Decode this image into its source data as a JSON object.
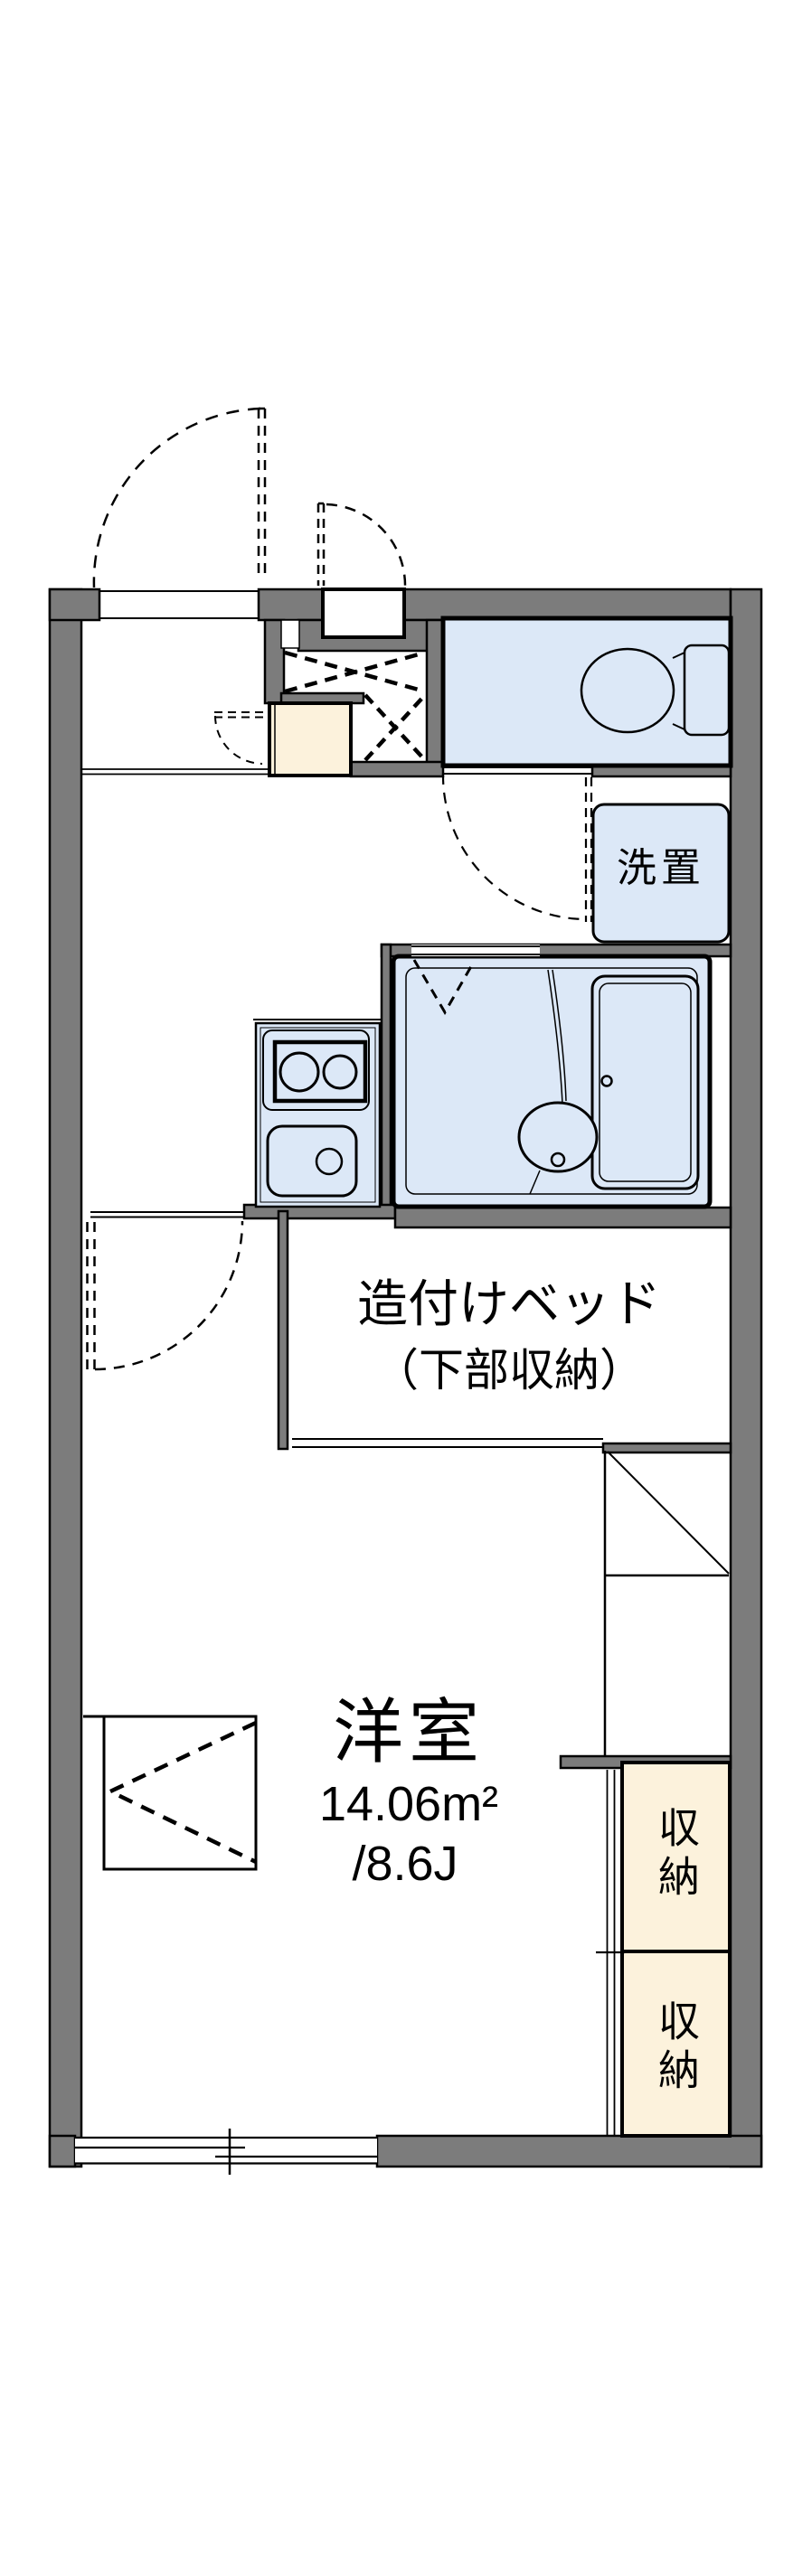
{
  "colors": {
    "wall": "#7c7c7c",
    "fixture_fill": "#dce8f7",
    "storage_fill": "#fcf2dc",
    "outline": "#000000",
    "background": "#ffffff"
  },
  "labels": {
    "main_room": {
      "name": "洋室",
      "area": "14.06m²",
      "size": "/8.6J"
    },
    "built_in_bed": {
      "line1": "造付けベッド",
      "line2": "（下部収納）"
    },
    "laundry": "洗置",
    "storage_upper": "収納",
    "storage_lower": "収納"
  }
}
